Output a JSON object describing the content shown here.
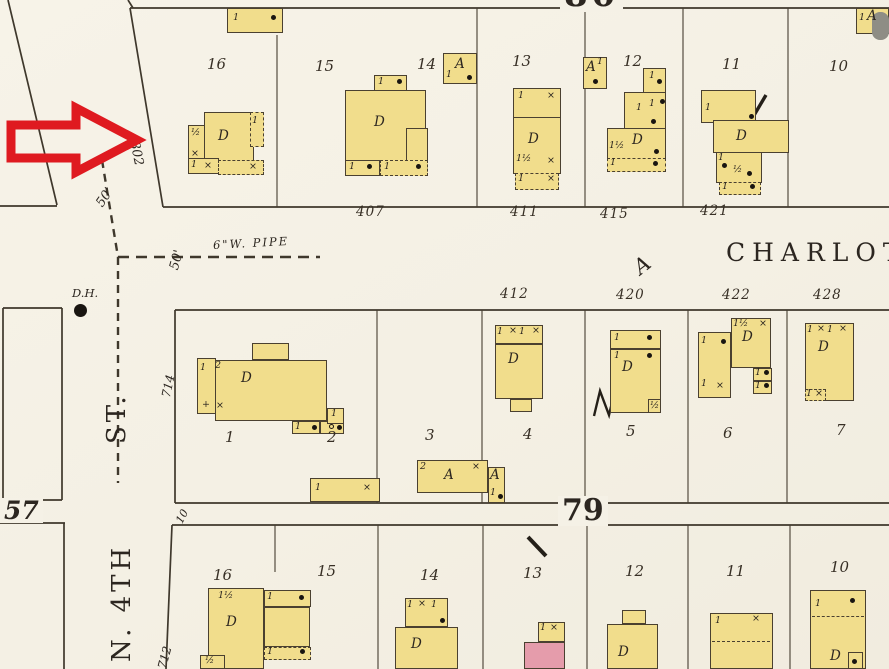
{
  "labels": {
    "block_north": "80",
    "block_south": "79",
    "block_west": "57",
    "charlotte": "CHARLOTT",
    "charlotte_class": "A",
    "st_abbrev": "ST.",
    "n_4th": "N. 4TH",
    "pipe": "6\"W. PIPE",
    "drain_hole": "D.H.",
    "dim_50_a": "50'",
    "dim_50_b": "50'",
    "num_802": "802",
    "num_714": "714",
    "num_712": "712",
    "dim_10": "10",
    "compass_n": "N"
  },
  "addresses": {
    "charlotte_north": [
      "407",
      "411",
      "415",
      "421"
    ],
    "charlotte_south": [
      "412",
      "420",
      "422",
      "428"
    ]
  },
  "lots": {
    "top": [
      "16",
      "15",
      "14",
      "13",
      "12",
      "11",
      "10"
    ],
    "middle": [
      "1",
      "2",
      "3",
      "4",
      "5",
      "6",
      "7"
    ],
    "bottom": [
      "16",
      "15",
      "14",
      "13",
      "12",
      "11",
      "10"
    ]
  },
  "glyphs": {
    "d": "D",
    "a": "A",
    "one": "1",
    "two": "2",
    "half": "½",
    "one_half": "1½",
    "x": "×",
    "plus": "+"
  }
}
